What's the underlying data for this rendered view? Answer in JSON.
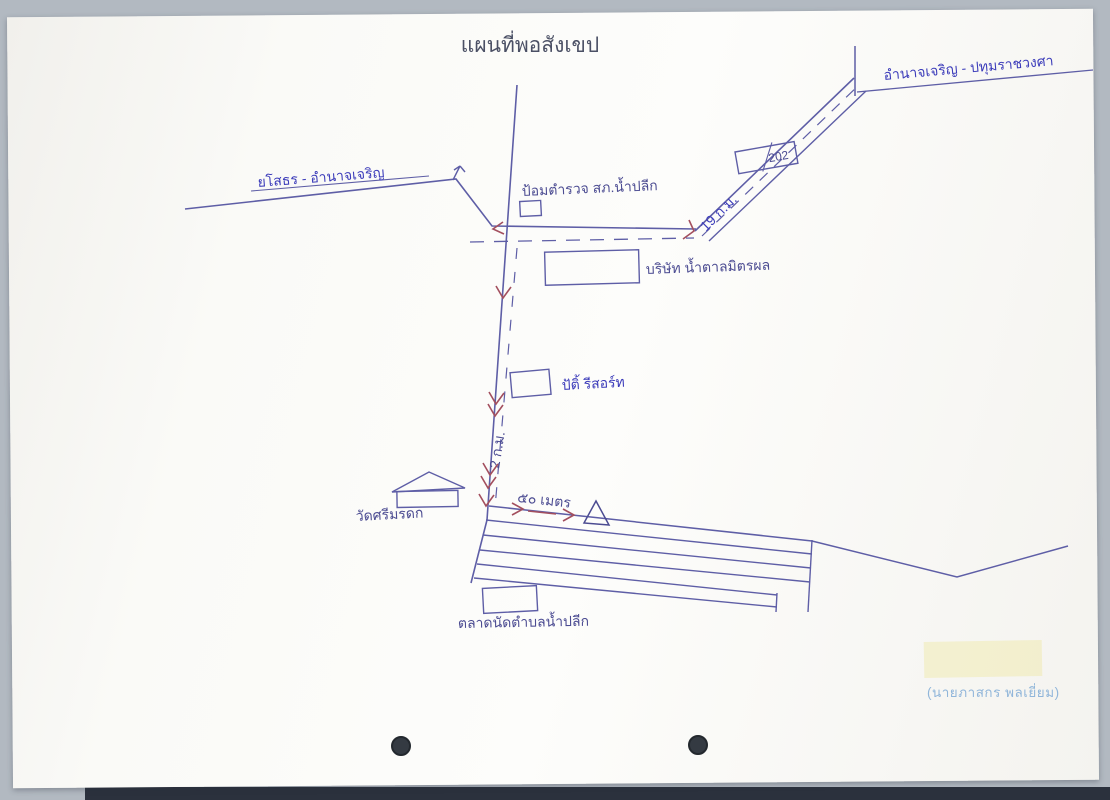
{
  "document": {
    "title": "แผนที่พอสังเขป",
    "signature_name": "(นายภาสกร  พลเยี่ยม)"
  },
  "roads": {
    "left_road_label": "ยโสธร - อำนาจเจริญ",
    "topright_road_label": "อำนาจเจริญ - ปทุมราชวงศา",
    "route_sign_number": "202",
    "distance_diagonal": "19 ก.ม.",
    "distance_vertical": "2 ก.ม.",
    "distance_bottom": "๕๐ เมตร"
  },
  "places": {
    "police_box_label": "ป้อมตำรวจ สภ.น้ำปลีก",
    "sugar_company_label": "บริษัท น้ำตาลมิตรผล",
    "resort_label": "ปัติ้ รีสอร์ท",
    "temple_label": "วัดศรีมรดก",
    "market_label": "ตลาดนัดตำบลน้ำปลีก"
  },
  "colors": {
    "ink": "#5e5ea6",
    "ink_dark": "#4c4c92",
    "hand_blue": "#3c3cba",
    "arrow_red": "#a34f5e",
    "printed": "#4b5065",
    "signature": "#91b6da",
    "paper": "#fbfaf7",
    "hole_punch": "#343a42"
  }
}
